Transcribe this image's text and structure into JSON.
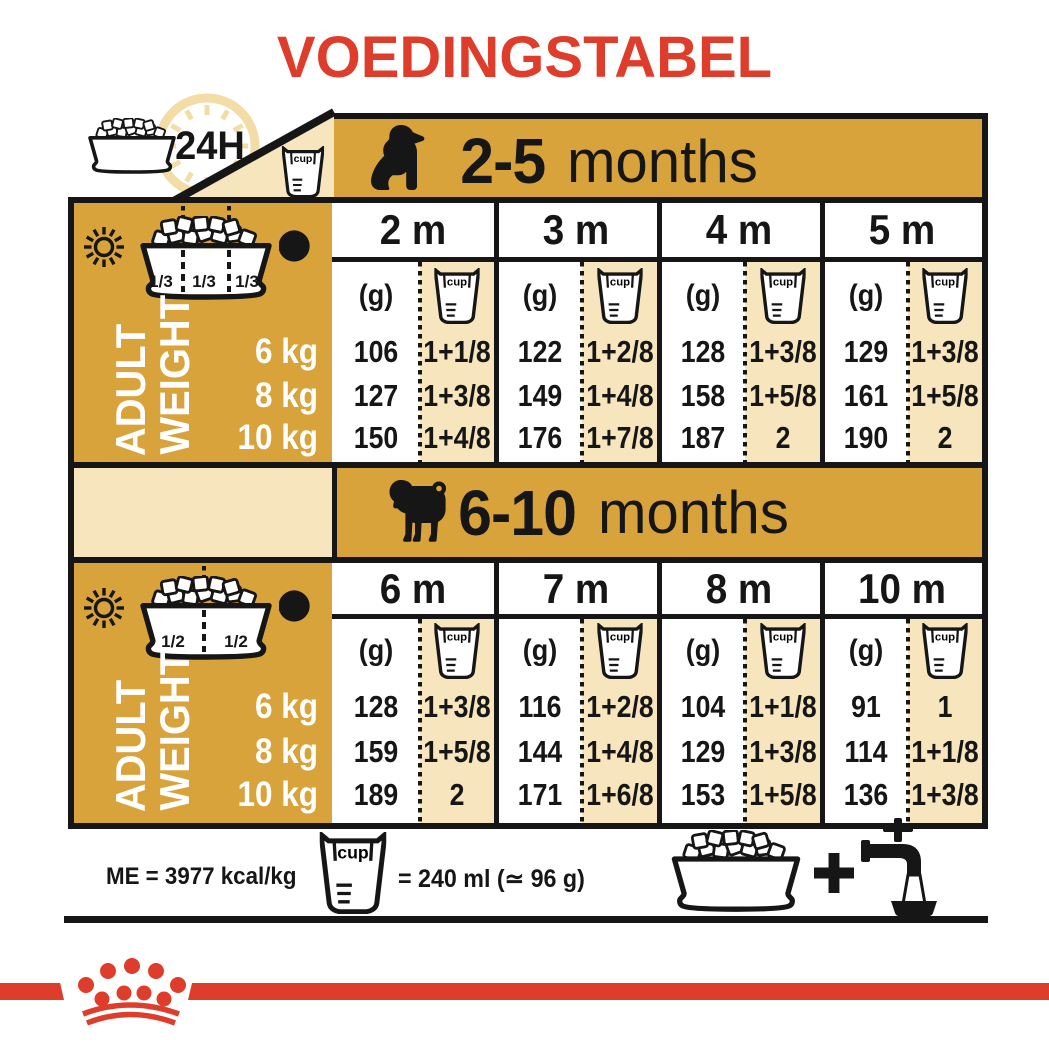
{
  "title": "VOEDINGSTABEL",
  "labels": {
    "cup": "cup",
    "duration": "24H",
    "adult": "ADULT",
    "weight": "WEIGHT",
    "unit_g": "(g)",
    "weights": [
      "6 kg",
      "8 kg",
      "10 kg"
    ]
  },
  "sections": [
    {
      "age_range": "2-5",
      "age_unit": "months",
      "dog_icon": "puppy-silhouette",
      "bowl_fractions": [
        "1/3",
        "1/3",
        "1/3"
      ],
      "columns": [
        {
          "month": "2 m",
          "grams": [
            "106",
            "127",
            "150"
          ],
          "cups": [
            "1+1/8",
            "1+3/8",
            "1+4/8"
          ]
        },
        {
          "month": "3 m",
          "grams": [
            "122",
            "149",
            "176"
          ],
          "cups": [
            "1+2/8",
            "1+4/8",
            "1+7/8"
          ]
        },
        {
          "month": "4 m",
          "grams": [
            "128",
            "158",
            "187"
          ],
          "cups": [
            "1+3/8",
            "1+5/8",
            "2"
          ]
        },
        {
          "month": "5 m",
          "grams": [
            "129",
            "161",
            "190"
          ],
          "cups": [
            "1+3/8",
            "1+5/8",
            "2"
          ]
        }
      ]
    },
    {
      "age_range": "6-10",
      "age_unit": "months",
      "dog_icon": "pug-silhouette",
      "bowl_fractions": [
        "1/2",
        "1/2"
      ],
      "columns": [
        {
          "month": "6 m",
          "grams": [
            "128",
            "159",
            "189"
          ],
          "cups": [
            "1+3/8",
            "1+5/8",
            "2"
          ]
        },
        {
          "month": "7 m",
          "grams": [
            "116",
            "144",
            "171"
          ],
          "cups": [
            "1+2/8",
            "1+4/8",
            "1+6/8"
          ]
        },
        {
          "month": "8 m",
          "grams": [
            "104",
            "129",
            "153"
          ],
          "cups": [
            "1+1/8",
            "1+3/8",
            "1+5/8"
          ]
        },
        {
          "month": "10 m",
          "grams": [
            "91",
            "114",
            "136"
          ],
          "cups": [
            "1",
            "1+1/8",
            "1+3/8"
          ]
        }
      ]
    }
  ],
  "footer": {
    "energy": "ME = 3977 kcal/kg",
    "cup_equivalence": "= 240 ml (≃ 96 g)",
    "plus": "+"
  },
  "colors": {
    "accent_red": "#DE3D2B",
    "gold": "#D9A33C",
    "cream": "#F7E5BE",
    "pale_gold": "#F3DCA6",
    "ink": "#161616"
  }
}
